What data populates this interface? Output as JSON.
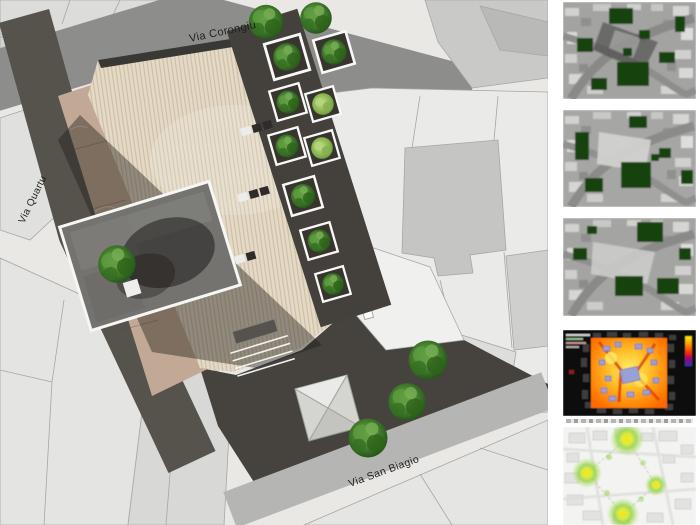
{
  "plan": {
    "street_labels": {
      "top": "Via Corongiu",
      "left": "Via Quartu",
      "bottom": "Via San Biagio"
    },
    "colors": {
      "paving_beige": "#e4dac6",
      "marble_tan": "#c2a995",
      "asphalt_dark": "#46433e",
      "planter_band_dark": "#44413c",
      "street_top_gray": "#8d8d8b",
      "street_left_dark": "#56524c",
      "street_bottom_light": "#b5b5b3",
      "parcel_light": "#e4e4e2",
      "water_basin_gray": "#747370"
    }
  },
  "sidebar": {
    "thumbnails": [
      {
        "name": "aerial-shadow-study-1"
      },
      {
        "name": "aerial-shadow-study-2"
      },
      {
        "name": "aerial-shadow-study-3"
      },
      {
        "name": "solar-radiation-analysis"
      },
      {
        "name": "light-visibility-analysis"
      }
    ],
    "analysis_colors": {
      "vegetation_green": "#15430c",
      "thermal_hot_orange": "#ff8c0a",
      "thermal_cool_blue": "#9aa0d6",
      "light_blob_yellow": "#f4ea00",
      "light_blob_green": "#8ed044"
    }
  }
}
